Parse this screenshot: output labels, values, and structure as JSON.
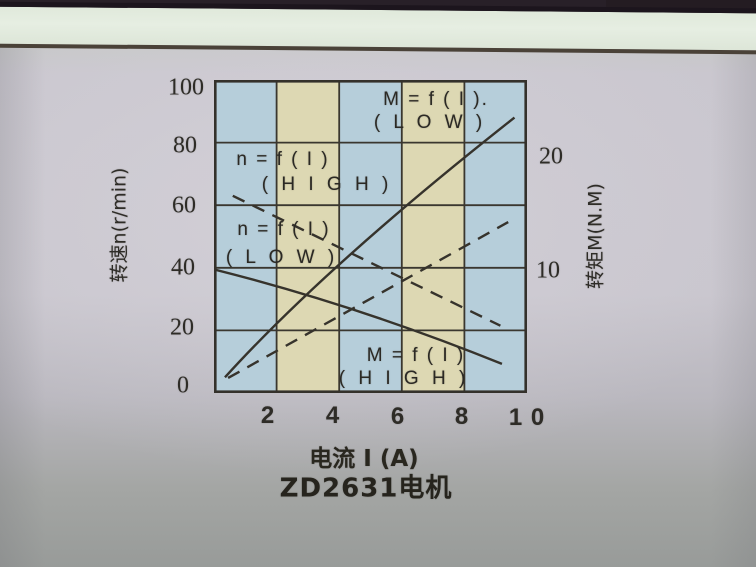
{
  "chart": {
    "curve_labels": {
      "m_low": {
        "line1": "M = f ( I ).",
        "line2": "( L O W )"
      },
      "n_high": {
        "line1": "n = f ( I )",
        "line2": "( H I G H )"
      },
      "n_low": {
        "line1": "n = f ( I )",
        "line2": "( L O W )"
      },
      "m_high": {
        "line1": "M = f ( I )",
        "line2": "( H I G H )"
      }
    },
    "y_left": {
      "title": "转速n(r/min)",
      "ticks": [
        "100",
        "80",
        "60",
        "40",
        "20",
        "0"
      ]
    },
    "y_right": {
      "title": "转矩M(N.M)",
      "ticks": [
        "20",
        "10"
      ]
    },
    "x_axis": {
      "title": "电流 I (A)",
      "ticks": [
        "2",
        "4",
        "6",
        "8",
        "1 0"
      ]
    },
    "caption": "ZD2631电机"
  },
  "chart_data": {
    "type": "line",
    "title": "ZD2631电机",
    "xlabel": "电流 I (A)",
    "ylabel_left": "转速n(r/min)",
    "ylabel_right": "转矩M(N.M)",
    "xlim": [
      0,
      10
    ],
    "ylim_left": [
      0,
      100
    ],
    "ylim_right": [
      0,
      25
    ],
    "x_ticks": [
      2,
      4,
      6,
      8,
      10
    ],
    "y_left_ticks": [
      0,
      20,
      40,
      60,
      80,
      100
    ],
    "y_right_ticks": [
      10,
      20
    ],
    "grid": true,
    "legend_position": "labels-inside-plot",
    "background_columns": [
      "#b6ceda",
      "#ddd8b3",
      "#b6ceda",
      "#ddd8b3",
      "#b6ceda"
    ],
    "series": [
      {
        "id": "m-low",
        "name": "M = f ( I ) ( L O W )",
        "axis": "right",
        "style": "solid",
        "x": [
          0.35,
          9.6
        ],
        "y_on_left_scale": [
          5,
          88
        ],
        "M_values": [
          1.25,
          22
        ]
      },
      {
        "id": "n-high",
        "name": "n = f ( I ) ( H I G H )",
        "axis": "left",
        "style": "dashed",
        "x": [
          0.6,
          9.15
        ],
        "y_on_left_scale": [
          63,
          21.5
        ],
        "n_values": [
          63,
          21.5
        ]
      },
      {
        "id": "n-low",
        "name": "n = f ( I ) ( L O W )",
        "axis": "left",
        "style": "solid",
        "x": [
          0,
          9.2
        ],
        "y_on_left_scale": [
          39.5,
          9.3
        ],
        "n_values": [
          39.5,
          9.3
        ]
      },
      {
        "id": "m-high",
        "name": "M = f ( I ) ( H I G H )",
        "axis": "right",
        "style": "dashed",
        "x": [
          0.45,
          9.4
        ],
        "y_on_left_scale": [
          4.8,
          54.6
        ],
        "M_values": [
          1.2,
          13.7
        ]
      }
    ]
  }
}
